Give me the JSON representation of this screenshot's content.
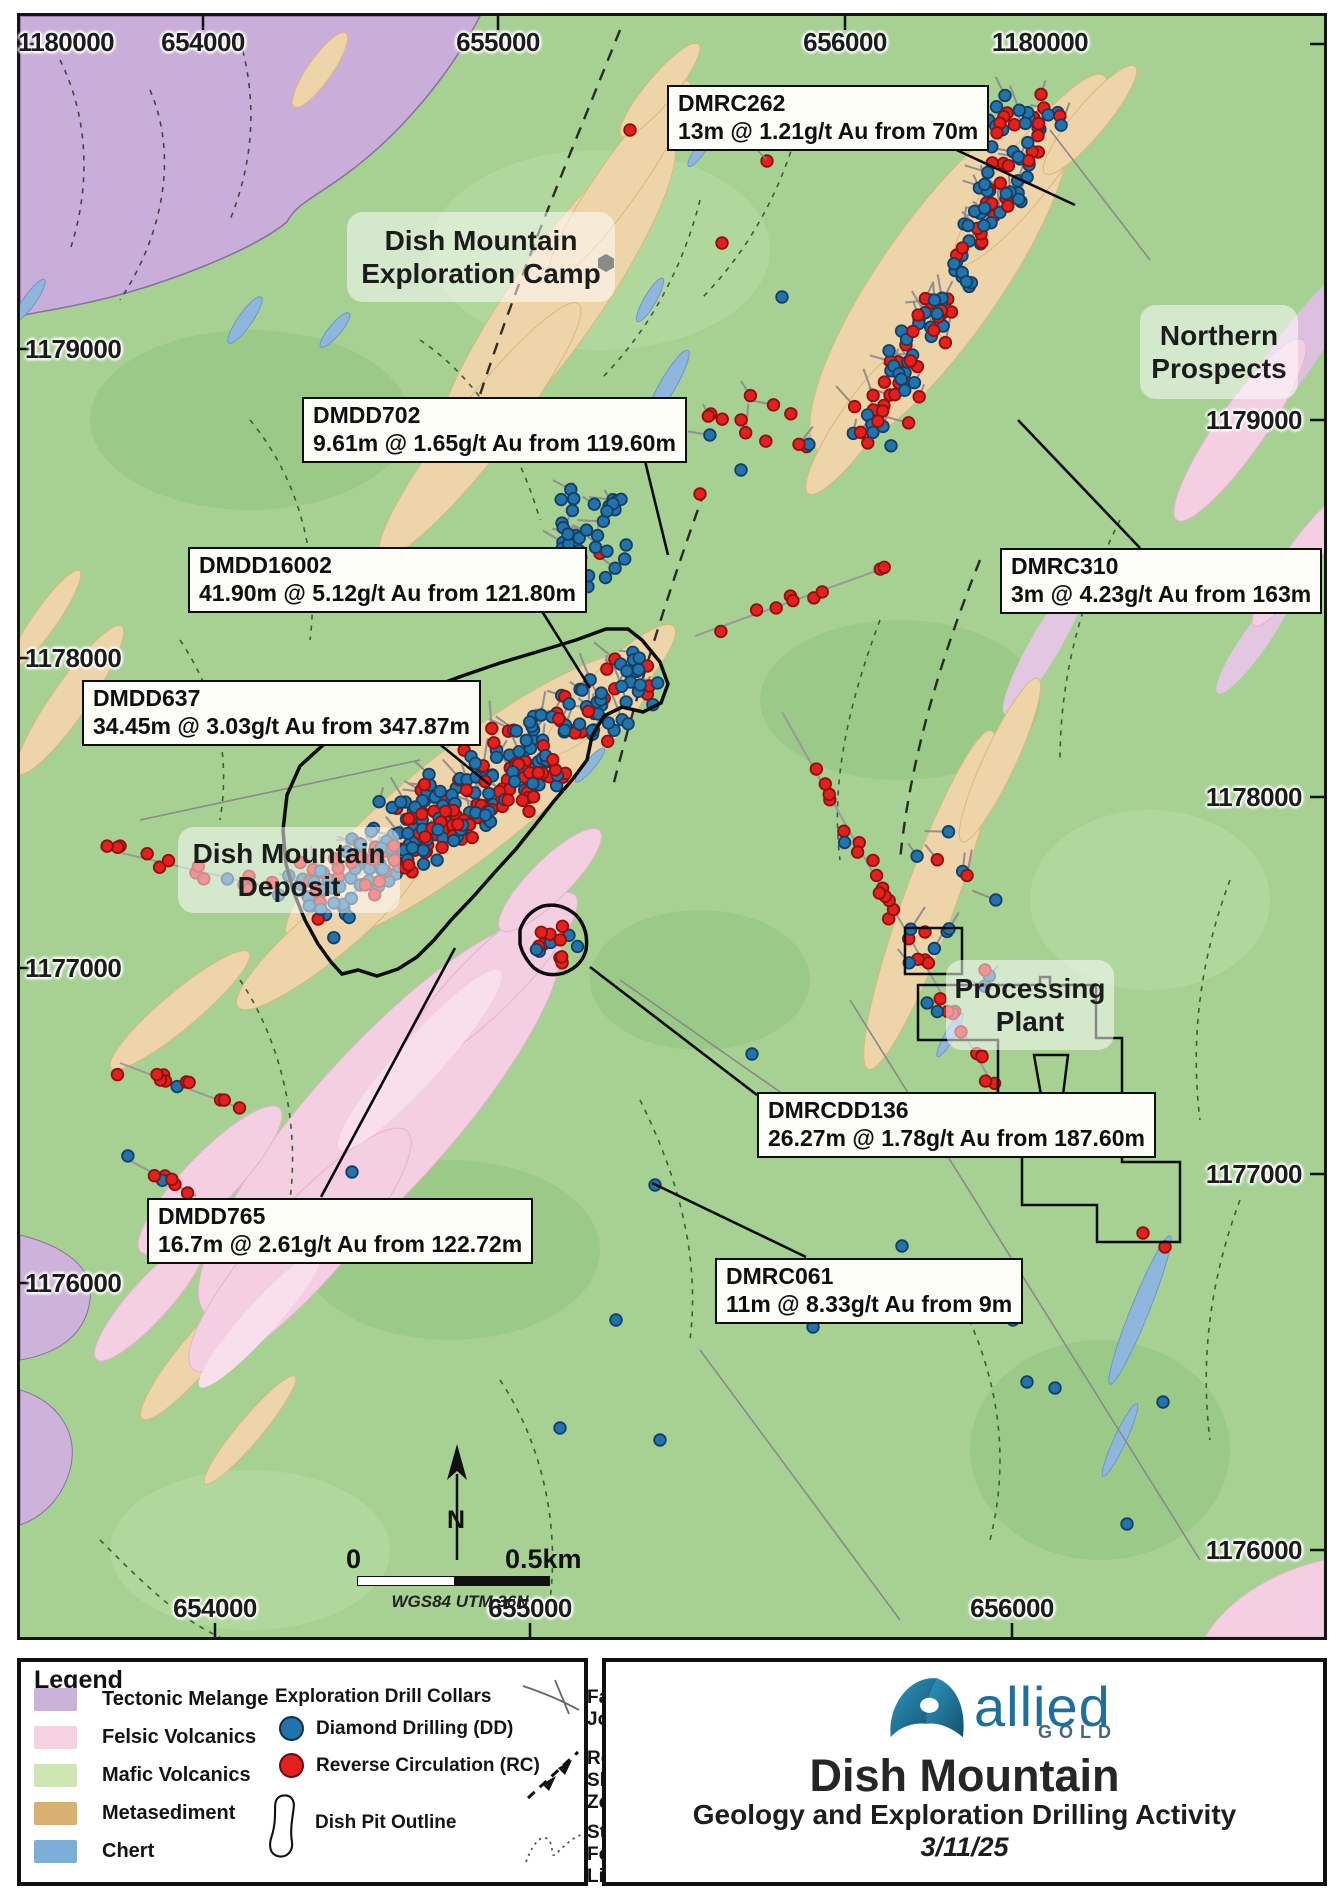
{
  "map": {
    "projection_note": "WGS84 UTM 36N",
    "scale": {
      "start_label": "0",
      "end_label": "0.5km",
      "north_label": "N"
    },
    "coords": {
      "top": [
        "1180000",
        "654000",
        "655000",
        "656000",
        "1180000"
      ],
      "left": [
        "1179000",
        "1178000",
        "1177000",
        "1176000"
      ],
      "right": [
        "1179000",
        "1178000",
        "1177000",
        "1176000"
      ],
      "bottom": [
        "654000",
        "655000",
        "656000"
      ]
    },
    "area_labels": [
      {
        "line1": "Dish Mountain",
        "line2": "Exploration Camp"
      },
      {
        "line1": "Northern",
        "line2": "Prospects"
      },
      {
        "line1": "Dish Mountain",
        "line2": "Deposit"
      },
      {
        "line1": "Processing",
        "line2": "Plant"
      }
    ],
    "callouts": [
      {
        "hole_id": "DMRC262",
        "result": "13m @ 1.21g/t Au from 70m"
      },
      {
        "hole_id": "DMDD702",
        "result": "9.61m @ 1.65g/t Au from 119.60m"
      },
      {
        "hole_id": "DMDD16002",
        "result": "41.90m @ 5.12g/t Au from 121.80m"
      },
      {
        "hole_id": "DMDD637",
        "result": "34.45m @ 3.03g/t Au from 347.87m"
      },
      {
        "hole_id": "DMRC310",
        "result": "3m @ 4.23g/t Au from 163m"
      },
      {
        "hole_id": "DMRCDD136",
        "result": "26.27m @ 1.78g/t Au from 187.60m"
      },
      {
        "hole_id": "DMDD765",
        "result": "16.7m @ 2.61g/t Au from 122.72m"
      },
      {
        "hole_id": "DMRC061",
        "result": "11m @ 8.33g/t Au from 9m"
      }
    ]
  },
  "legend": {
    "title": "Legend",
    "geology_units": [
      {
        "label": "Tectonic Melange",
        "color": "#cbb2d8"
      },
      {
        "label": "Felsic Volcanics",
        "color": "#f5d2e2"
      },
      {
        "label": "Mafic Volcanics",
        "color": "#cde6b2"
      },
      {
        "label": "Metasediment",
        "color": "#d8b172"
      },
      {
        "label": "Chert",
        "color": "#7fadd9"
      }
    ],
    "drill_collars": {
      "header": "Exploration Drill Collars",
      "items": [
        {
          "label": "Diamond Drilling (DD)",
          "color": "#2173ad"
        },
        {
          "label": "Reverse Circulation (RC)",
          "color": "#e3201b"
        }
      ],
      "pit_label": "Dish Pit Outline"
    },
    "structures": [
      {
        "line1": "Fault-Joint",
        "line2": ""
      },
      {
        "line1": "Reverse",
        "line2": "Shear Zone"
      },
      {
        "line1": "Structural",
        "line2": "Form Line"
      }
    ]
  },
  "title_block": {
    "brand": "allied",
    "brand_sub": "GOLD",
    "title": "Dish Mountain",
    "subtitle": "Geology and Exploration Drilling Activity",
    "date": "3/11/25"
  },
  "drill_symbols": {
    "dd_fill": "#2173ad",
    "dd_stroke": "#143f63",
    "rc_fill": "#e3201b",
    "rc_stroke": "#8e100f"
  },
  "drill_clusters": [
    {
      "type": "band",
      "x1": 862,
      "y1": 448,
      "x2": 1040,
      "y2": 112,
      "halfw": 36,
      "n": 120,
      "red": 0.55,
      "tails": true
    },
    {
      "type": "blob",
      "cx": 1020,
      "cy": 128,
      "rx": 44,
      "ry": 40,
      "n": 26,
      "red": 0.5,
      "tails": true
    },
    {
      "type": "blob",
      "cx": 588,
      "cy": 532,
      "rx": 44,
      "ry": 58,
      "n": 38,
      "red": 0.07,
      "tails": true
    },
    {
      "type": "blob",
      "cx": 762,
      "cy": 428,
      "rx": 58,
      "ry": 34,
      "n": 13,
      "red": 0.55,
      "tails": true
    },
    {
      "type": "band",
      "x1": 305,
      "y1": 900,
      "x2": 650,
      "y2": 668,
      "halfw": 52,
      "n": 230,
      "red": 0.38,
      "tails": true
    },
    {
      "type": "band",
      "x1": 360,
      "y1": 880,
      "x2": 560,
      "y2": 762,
      "halfw": 34,
      "n": 110,
      "red": 0.55,
      "tails": false
    },
    {
      "type": "blob",
      "cx": 552,
      "cy": 944,
      "rx": 27,
      "ry": 21,
      "n": 15,
      "red": 0.8,
      "tails": false
    },
    {
      "type": "band",
      "x1": 100,
      "y1": 848,
      "x2": 280,
      "y2": 890,
      "halfw": 13,
      "n": 15,
      "red": 0.72,
      "trace": true
    },
    {
      "type": "band",
      "x1": 120,
      "y1": 1063,
      "x2": 245,
      "y2": 1110,
      "halfw": 17,
      "n": 11,
      "red": 0.6,
      "trace": true
    },
    {
      "type": "band",
      "x1": 125,
      "y1": 1158,
      "x2": 196,
      "y2": 1196,
      "halfw": 10,
      "n": 7,
      "red": 0.7,
      "trace": true
    },
    {
      "type": "band",
      "x1": 695,
      "y1": 636,
      "x2": 890,
      "y2": 566,
      "halfw": 8,
      "n": 9,
      "red": 0.95,
      "trace": true
    },
    {
      "type": "band",
      "x1": 782,
      "y1": 712,
      "x2": 1005,
      "y2": 1106,
      "halfw": 10,
      "n": 30,
      "red": 0.9,
      "trace": true
    },
    {
      "type": "blob",
      "cx": 950,
      "cy": 925,
      "rx": 50,
      "ry": 105,
      "n": 15,
      "red": 0.2,
      "tails": true
    }
  ],
  "drill_singles": [
    {
      "x": 767,
      "y": 161,
      "c": "r"
    },
    {
      "x": 630,
      "y": 130,
      "c": "r"
    },
    {
      "x": 722,
      "y": 243,
      "c": "r"
    },
    {
      "x": 782,
      "y": 297,
      "c": "b"
    },
    {
      "x": 700,
      "y": 494,
      "c": "r"
    },
    {
      "x": 741,
      "y": 470,
      "c": "b"
    },
    {
      "x": 352,
      "y": 1172,
      "c": "b"
    },
    {
      "x": 655,
      "y": 1185,
      "c": "b"
    },
    {
      "x": 752,
      "y": 1054,
      "c": "b"
    },
    {
      "x": 616,
      "y": 1320,
      "c": "b"
    },
    {
      "x": 813,
      "y": 1327,
      "c": "b"
    },
    {
      "x": 902,
      "y": 1246,
      "c": "b"
    },
    {
      "x": 1013,
      "y": 1320,
      "c": "b"
    },
    {
      "x": 1027,
      "y": 1382,
      "c": "b"
    },
    {
      "x": 1055,
      "y": 1388,
      "c": "b"
    },
    {
      "x": 1163,
      "y": 1402,
      "c": "b"
    },
    {
      "x": 1127,
      "y": 1524,
      "c": "b"
    },
    {
      "x": 1143,
      "y": 1233,
      "c": "r"
    },
    {
      "x": 1165,
      "y": 1247,
      "c": "r"
    },
    {
      "x": 925,
      "y": 932,
      "c": "r"
    },
    {
      "x": 985,
      "y": 970,
      "c": "r"
    },
    {
      "x": 560,
      "y": 1428,
      "c": "b"
    },
    {
      "x": 660,
      "y": 1440,
      "c": "b"
    }
  ]
}
